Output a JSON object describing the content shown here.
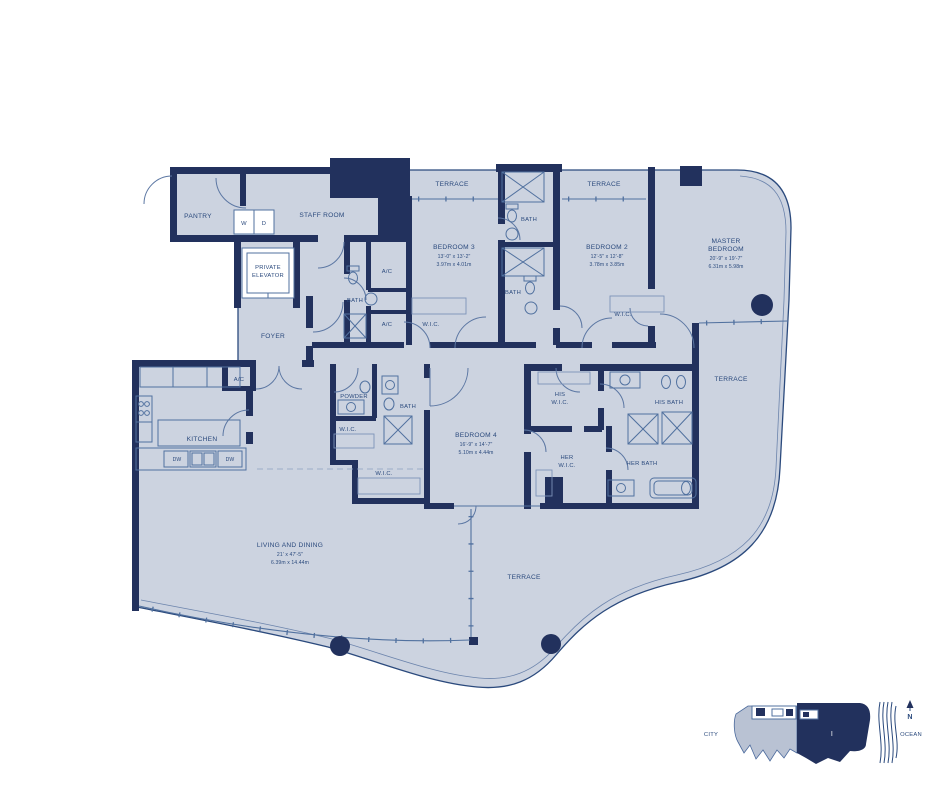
{
  "colors": {
    "background": "#ffffff",
    "floor_fill": "#ccd3e0",
    "wall": "#22315d",
    "line": "#51719f",
    "text": "#2b4a7d",
    "keyplan_light": "#b9c2d3",
    "keyplan_dark": "#22315d"
  },
  "rooms": {
    "pantry": {
      "label": "PANTRY"
    },
    "staff_room": {
      "label": "STAFF ROOM"
    },
    "washer": {
      "label": "W"
    },
    "dryer": {
      "label": "D"
    },
    "private_elevator": {
      "line1": "PRIVATE",
      "line2": "ELEVATOR"
    },
    "foyer": {
      "label": "FOYER"
    },
    "ac_upper": {
      "label": "A/C"
    },
    "bath_staff": {
      "label": "BATH"
    },
    "ac_mid": {
      "label": "A/C"
    },
    "wic_bed3": {
      "label": "W.I.C."
    },
    "terrace_top_left": {
      "label": "TERRACE"
    },
    "bath_top": {
      "label": "BATH"
    },
    "terrace_top_right": {
      "label": "TERRACE"
    },
    "bedroom3": {
      "label": "BEDROOM 3",
      "dims_ft": "13'-0\" x 13'-2\"",
      "dims_m": "3.97m x 4.01m"
    },
    "bath_mid": {
      "label": "BATH"
    },
    "bedroom2": {
      "label": "BEDROOM 2",
      "dims_ft": "12'-5\" x 12'-8\"",
      "dims_m": "3.78m x 3.85m"
    },
    "wic_bed2": {
      "label": "W.I.C."
    },
    "master_bedroom": {
      "line1": "MASTER",
      "line2": "BEDROOM",
      "dims_ft": "20'-9\" x 19'-7\"",
      "dims_m": "6.31m x 5.98m"
    },
    "terrace_master": {
      "label": "TERRACE"
    },
    "ac_kitchen": {
      "label": "A/C"
    },
    "powder": {
      "label": "POWDER"
    },
    "bath_bed4": {
      "label": "BATH"
    },
    "wic_powder": {
      "label": "W.I.C."
    },
    "kitchen": {
      "label": "KITCHEN"
    },
    "dw1": {
      "label": "DW"
    },
    "dw2": {
      "label": "DW"
    },
    "wic_bed4": {
      "label": "W.I.C."
    },
    "bedroom4": {
      "label": "BEDROOM 4",
      "dims_ft": "16'-9\" x 14'-7\"",
      "dims_m": "5.10m x 4.44m"
    },
    "his_wic": {
      "line1": "HIS",
      "line2": "W.I.C."
    },
    "his_bath": {
      "label": "HIS BATH"
    },
    "her_wic": {
      "line1": "HER",
      "line2": "W.I.C."
    },
    "her_bath": {
      "label": "HER BATH"
    },
    "living_dining": {
      "label": "LIVING AND DINING",
      "dims_ft": "21' x 47'-5\"",
      "dims_m": "6.39m x 14.44m"
    },
    "terrace_bottom": {
      "label": "TERRACE"
    }
  },
  "keyplan": {
    "city_label": "CITY",
    "ocean_label": "OCEAN",
    "north_label": "N",
    "unit_label": "I"
  }
}
